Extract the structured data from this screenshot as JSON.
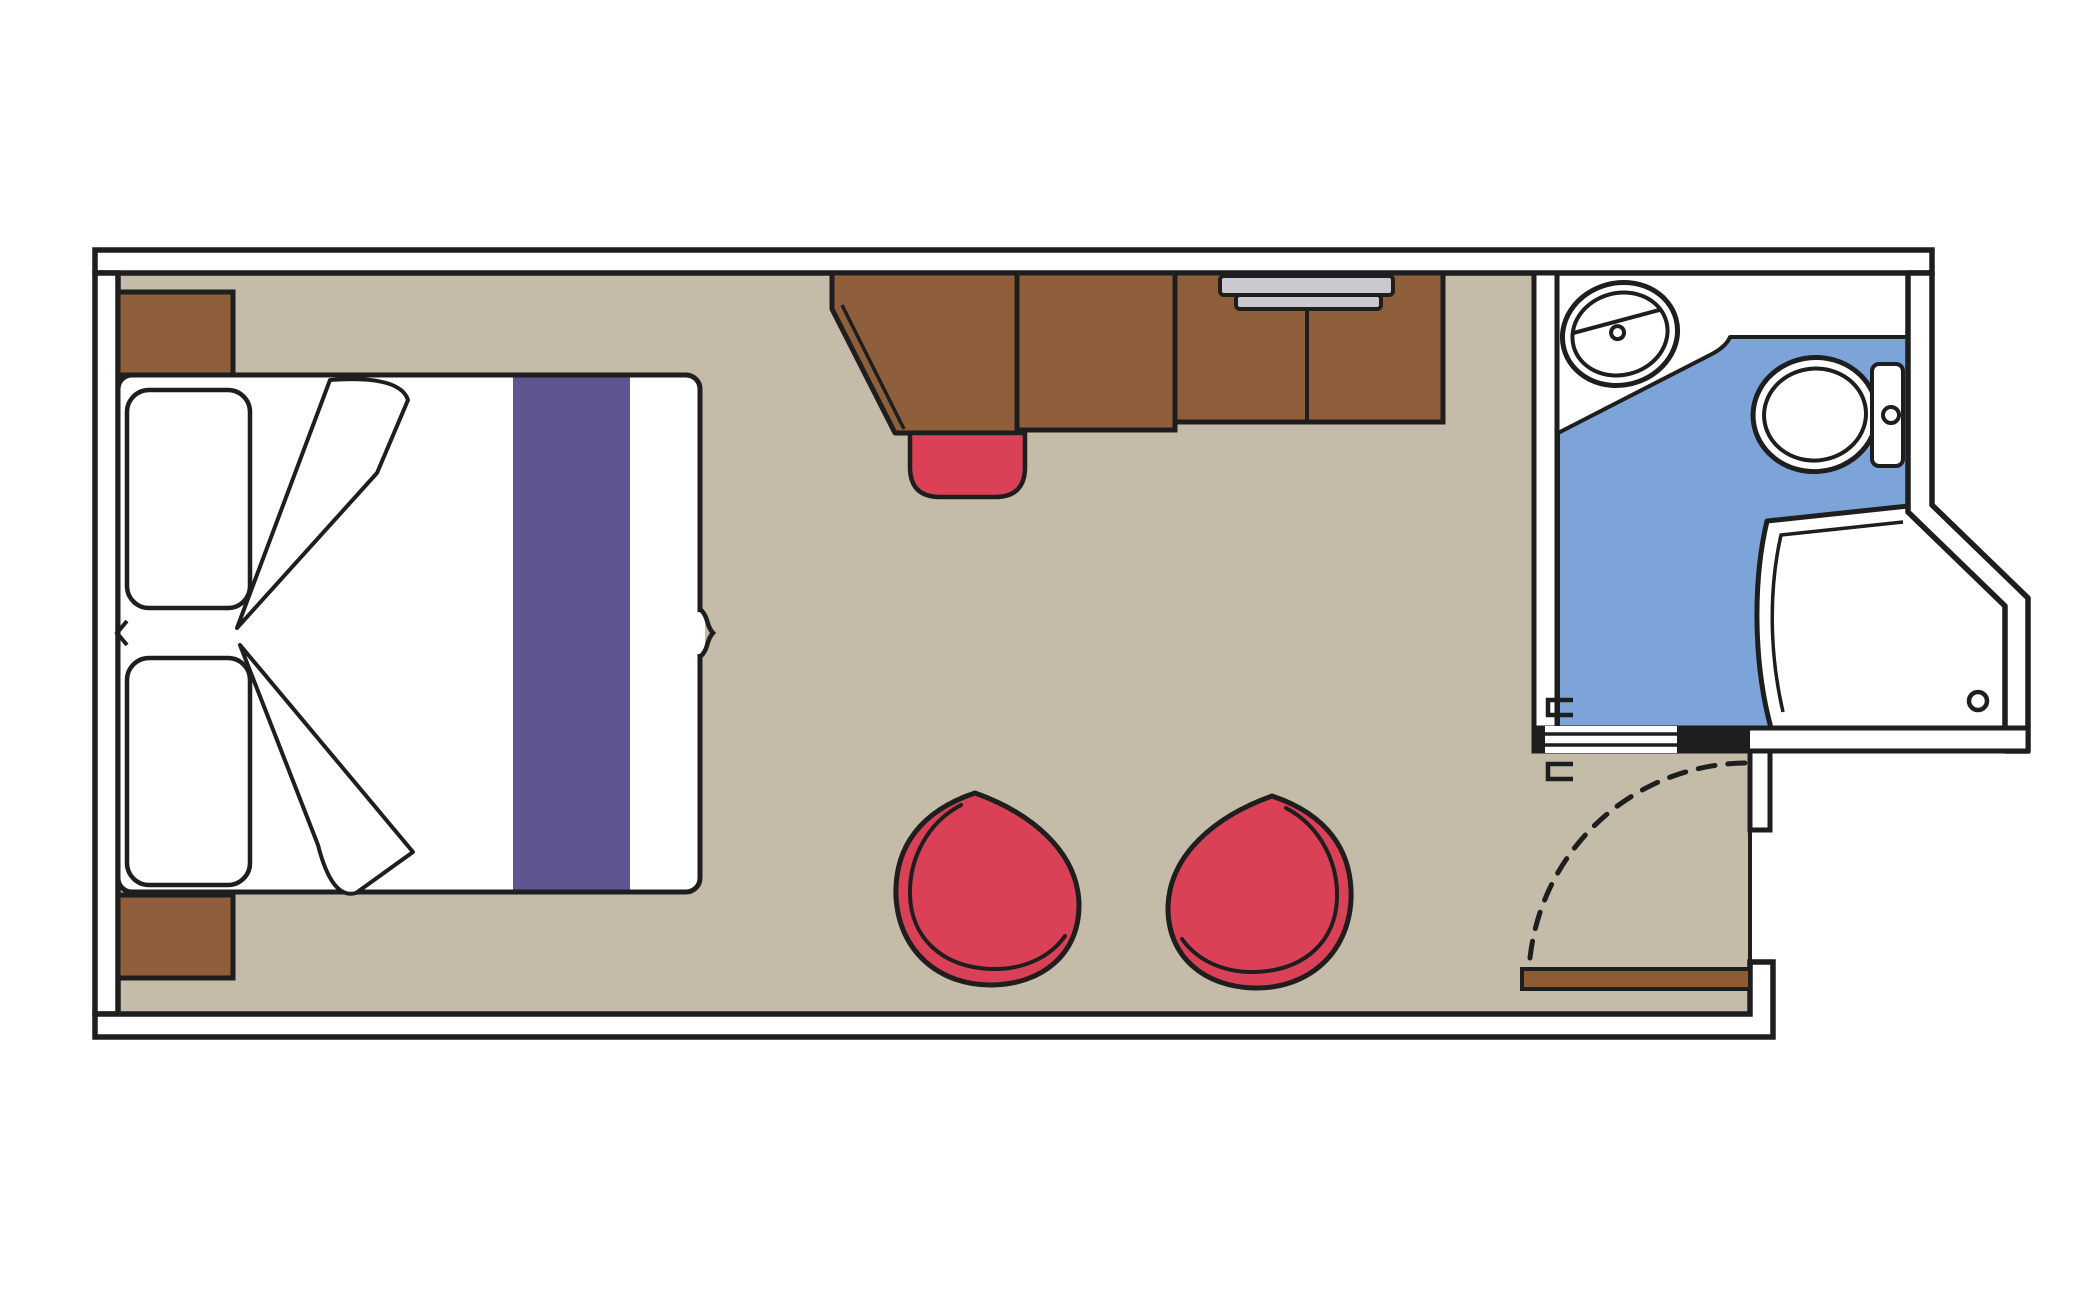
{
  "meta": {
    "title": "Cabin floor plan",
    "type": "floor-plan",
    "rooms": [
      "bedroom-sitting-area",
      "bathroom",
      "entry"
    ]
  },
  "colors": {
    "background": "#FFFFFF",
    "wall_fill": "#FFFFFF",
    "line": "#1E1E1E",
    "floor": "#C4BBA9",
    "furniture_brown": "#8F5E3B",
    "door_brown": "#8E5B34",
    "accent_red": "#DB4156",
    "runner_purple": "#5F5590",
    "bath_floor_blue": "#7CA4D9",
    "fixture_white": "#FFFFFF",
    "shelf_gray": "#C9C9CE"
  },
  "inventory": {
    "bed": "double bed with two pillows, folded blanket corners and purple runner",
    "nightstands": 2,
    "desk_unit": "desk with chamfered corner, cabinet and wardrobe with TV shelf",
    "stool": "red desk stool",
    "chairs": "two red tub chairs",
    "bathroom": "sink counter, toilet, curved shower enclosure, sliding door",
    "entry": "entry door with swing arc"
  }
}
